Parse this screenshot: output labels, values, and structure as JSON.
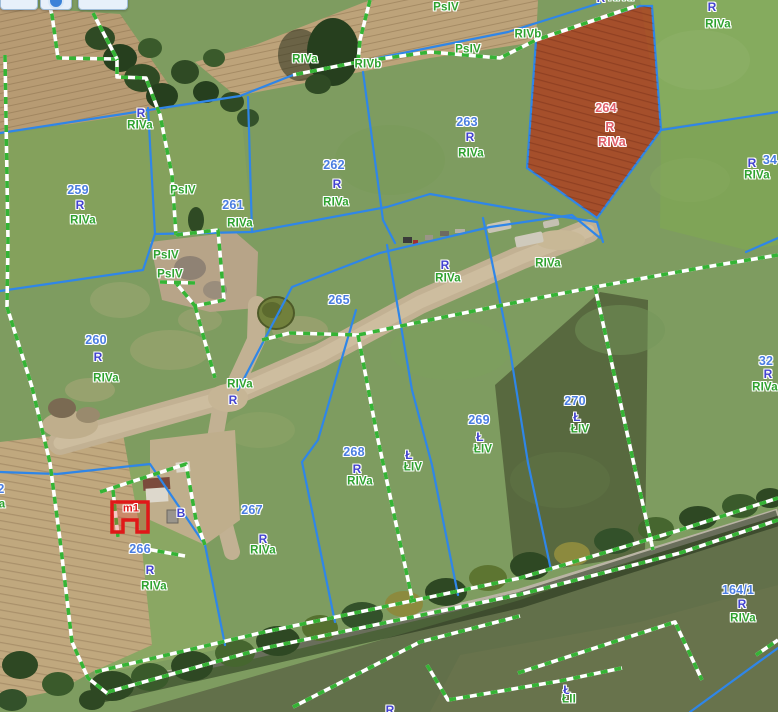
{
  "map": {
    "description": "Aerial cadastral map with parcel boundaries, soil-class labels, one highlighted parcel and one highlighted building",
    "colors": {
      "boundary_blue": "#2f86e8",
      "cadastral_green": "#35b435",
      "parcel_number_blue": "#4a7de0",
      "land_use_purple": "#4343cf",
      "soil_green": "#2ea22e",
      "highlight_fill": "#b5431f",
      "highlight_label": "#df5f6b",
      "building_outline_red": "#e01818"
    },
    "highlighted_parcel": {
      "number": "264",
      "land_use": "R",
      "soil_class": "RIVa"
    },
    "highlighted_building": {
      "id": "m1"
    },
    "labels": [
      {
        "t": "R",
        "x": 141,
        "y": 113,
        "c": "r"
      },
      {
        "t": "RIVa",
        "x": 140,
        "y": 126,
        "c": "soil"
      },
      {
        "t": "259",
        "x": 78,
        "y": 190,
        "c": "num"
      },
      {
        "t": "R",
        "x": 80,
        "y": 205,
        "c": "r"
      },
      {
        "t": "RIVa",
        "x": 83,
        "y": 221,
        "c": "soil"
      },
      {
        "t": "PsIV",
        "x": 183,
        "y": 191,
        "c": "soil"
      },
      {
        "t": "261",
        "x": 233,
        "y": 205,
        "c": "num"
      },
      {
        "t": "RIVa",
        "x": 240,
        "y": 224,
        "c": "soil"
      },
      {
        "t": "RIVa",
        "x": 305,
        "y": 60,
        "c": "soil"
      },
      {
        "t": "RIVb",
        "x": 368,
        "y": 65,
        "c": "soil"
      },
      {
        "t": "PsIV",
        "x": 446,
        "y": 8,
        "c": "soil"
      },
      {
        "t": "PsIV",
        "x": 468,
        "y": 50,
        "c": "soil"
      },
      {
        "t": "RIVb",
        "x": 528,
        "y": 35,
        "c": "soil"
      },
      {
        "t": "262",
        "x": 334,
        "y": 165,
        "c": "num"
      },
      {
        "t": "R",
        "x": 337,
        "y": 184,
        "c": "r"
      },
      {
        "t": "RIVa",
        "x": 336,
        "y": 203,
        "c": "soil"
      },
      {
        "t": "263",
        "x": 467,
        "y": 122,
        "c": "num"
      },
      {
        "t": "R",
        "x": 470,
        "y": 137,
        "c": "r"
      },
      {
        "t": "RIVa",
        "x": 471,
        "y": 154,
        "c": "soil"
      },
      {
        "t": "264",
        "x": 606,
        "y": 108,
        "c": "red-num"
      },
      {
        "t": "R",
        "x": 610,
        "y": 127,
        "c": "red-num"
      },
      {
        "t": "RIVa",
        "x": 612,
        "y": 142,
        "c": "red-num"
      },
      {
        "t": "R",
        "x": 712,
        "y": 7,
        "c": "r"
      },
      {
        "t": "RIVa",
        "x": 718,
        "y": 25,
        "c": "soil"
      },
      {
        "t": "R",
        "x": 752,
        "y": 163,
        "c": "r"
      },
      {
        "t": "34",
        "x": 770,
        "y": 160,
        "c": "num"
      },
      {
        "t": "RIVa",
        "x": 757,
        "y": 176,
        "c": "soil"
      },
      {
        "t": "PsIV",
        "x": 166,
        "y": 256,
        "c": "soil"
      },
      {
        "t": "PsIV",
        "x": 170,
        "y": 275,
        "c": "soil"
      },
      {
        "t": "260",
        "x": 96,
        "y": 340,
        "c": "num"
      },
      {
        "t": "R",
        "x": 98,
        "y": 357,
        "c": "r"
      },
      {
        "t": "RIVa",
        "x": 106,
        "y": 379,
        "c": "soil"
      },
      {
        "t": "265",
        "x": 339,
        "y": 300,
        "c": "num"
      },
      {
        "t": "R",
        "x": 445,
        "y": 265,
        "c": "r"
      },
      {
        "t": "RIVa",
        "x": 448,
        "y": 279,
        "c": "soil"
      },
      {
        "t": "RIVa",
        "x": 548,
        "y": 264,
        "c": "soil"
      },
      {
        "t": "RIVa",
        "x": 240,
        "y": 385,
        "c": "soil"
      },
      {
        "t": "R",
        "x": 233,
        "y": 400,
        "c": "r"
      },
      {
        "t": "32",
        "x": 766,
        "y": 361,
        "c": "num"
      },
      {
        "t": "R",
        "x": 768,
        "y": 374,
        "c": "r"
      },
      {
        "t": "RIVa",
        "x": 765,
        "y": 388,
        "c": "soil"
      },
      {
        "t": "270",
        "x": 575,
        "y": 401,
        "c": "num"
      },
      {
        "t": "Ł",
        "x": 577,
        "y": 417,
        "c": "r"
      },
      {
        "t": "ŁIV",
        "x": 580,
        "y": 430,
        "c": "soil"
      },
      {
        "t": "269",
        "x": 479,
        "y": 420,
        "c": "num"
      },
      {
        "t": "Ł",
        "x": 480,
        "y": 437,
        "c": "r"
      },
      {
        "t": "ŁIV",
        "x": 483,
        "y": 450,
        "c": "soil"
      },
      {
        "t": "268",
        "x": 354,
        "y": 452,
        "c": "num"
      },
      {
        "t": "R",
        "x": 357,
        "y": 469,
        "c": "r"
      },
      {
        "t": "RIVa",
        "x": 360,
        "y": 482,
        "c": "soil"
      },
      {
        "t": "Ł",
        "x": 409,
        "y": 455,
        "c": "r"
      },
      {
        "t": "ŁIV",
        "x": 413,
        "y": 468,
        "c": "soil"
      },
      {
        "t": "m1",
        "x": 131,
        "y": 509,
        "c": "m1"
      },
      {
        "t": "B",
        "x": 181,
        "y": 513,
        "c": "r"
      },
      {
        "t": "266",
        "x": 140,
        "y": 549,
        "c": "num"
      },
      {
        "t": "R",
        "x": 150,
        "y": 570,
        "c": "r"
      },
      {
        "t": "RIVa",
        "x": 154,
        "y": 587,
        "c": "soil"
      },
      {
        "t": "267",
        "x": 252,
        "y": 510,
        "c": "num"
      },
      {
        "t": "R",
        "x": 263,
        "y": 539,
        "c": "r"
      },
      {
        "t": "RIVa",
        "x": 263,
        "y": 551,
        "c": "soil"
      },
      {
        "t": "164/1",
        "x": 738,
        "y": 590,
        "c": "num"
      },
      {
        "t": "R",
        "x": 742,
        "y": 604,
        "c": "r"
      },
      {
        "t": "RIVa",
        "x": 743,
        "y": 619,
        "c": "soil"
      },
      {
        "t": "Ł",
        "x": 567,
        "y": 690,
        "c": "r"
      },
      {
        "t": "ŁII",
        "x": 569,
        "y": 700,
        "c": "soil"
      },
      {
        "t": "R",
        "x": 390,
        "y": 710,
        "c": "r"
      },
      {
        "t": "2",
        "x": 1,
        "y": 489,
        "c": "num"
      },
      {
        "t": "a",
        "x": 2,
        "y": 505,
        "c": "soil"
      },
      {
        "t": "R",
        "x": 601,
        "y": -2,
        "c": "r"
      },
      {
        "t": "RIVa",
        "x": 621,
        "y": -2,
        "c": "soil"
      }
    ]
  },
  "toolbar": {
    "note": "partially visible toolbar buttons clipped at top edge",
    "icons": [
      "circle-icon"
    ]
  }
}
